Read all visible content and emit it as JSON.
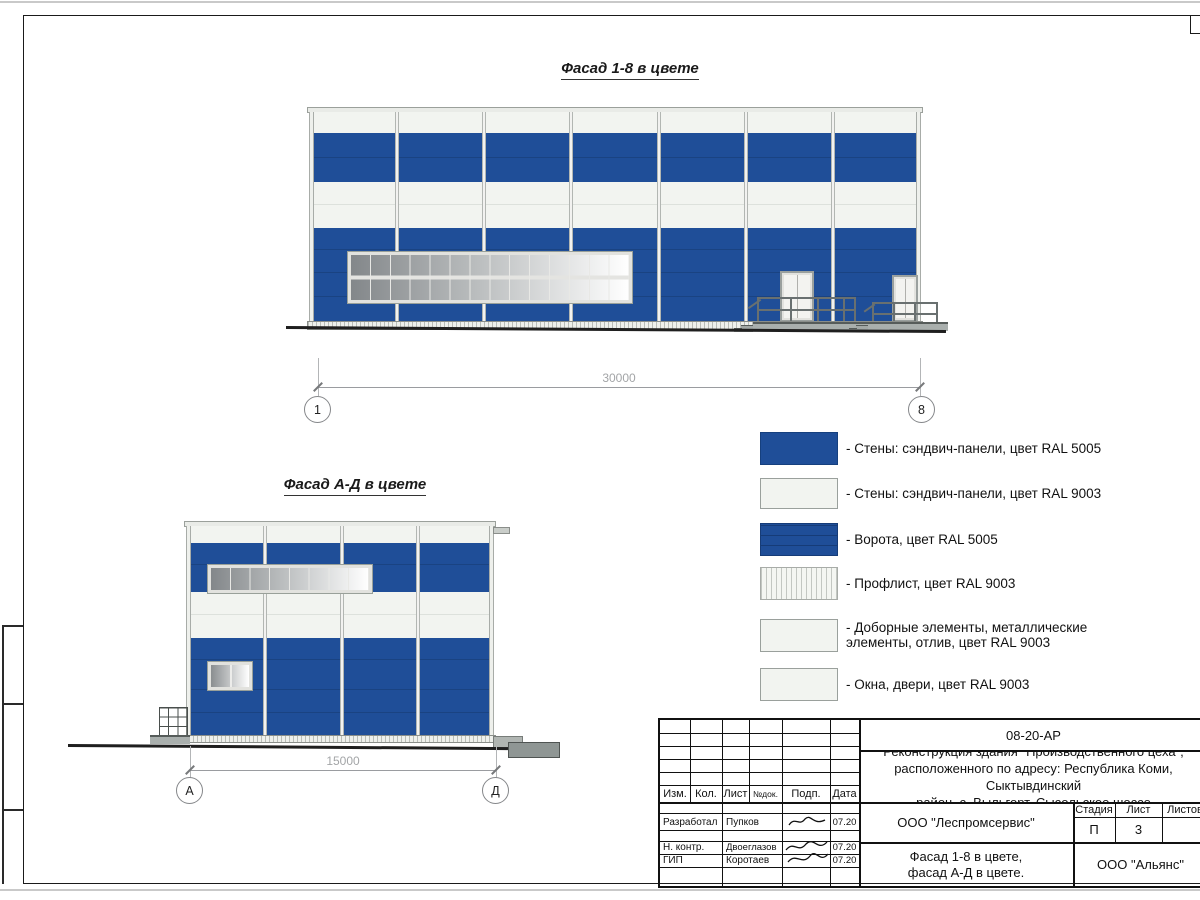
{
  "titles": {
    "facade1": "Фасад 1-8 в цвете",
    "facade2": "Фасад А-Д в цвете"
  },
  "dims": {
    "f1": {
      "value": "30000",
      "left": "1",
      "right": "8"
    },
    "f2": {
      "value": "15000",
      "left": "А",
      "right": "Д"
    }
  },
  "legend": {
    "items": [
      {
        "swatch": "wall-blue",
        "label": "- Стены: сэндвич-панели, цвет RAL 5005"
      },
      {
        "swatch": "wall-white",
        "label": "- Стены: сэндвич-панели, цвет RAL 9003"
      },
      {
        "swatch": "gate-blue",
        "label": "- Ворота, цвет RAL 5005"
      },
      {
        "swatch": "profiled-sheet",
        "label": "- Профлист, цвет RAL 9003"
      },
      {
        "swatch": "trim-elements",
        "label": "- Доборные элементы, металлические элементы, отлив, цвет RAL 9003"
      },
      {
        "swatch": "windows-doors",
        "label": "- Окна, двери, цвет RAL 9003"
      }
    ]
  },
  "tb": {
    "code": "08-20-АР",
    "project": "Реконструкция здания \"Производственного цеха\",\nрасположенного по адресу: Республика Коми, Сыктывдинский\nрайон, с. Выльгорт, Сысольское шоссе",
    "cols": [
      "Изм.",
      "Кол.",
      "Лист",
      "№док.",
      "Подп.",
      "Дата"
    ],
    "rows": [
      {
        "role": "Разработал",
        "name": "Пупков",
        "date": "07.20"
      },
      {
        "role": "Н. контр.",
        "name": "Двоеглазов",
        "date": "07.20"
      },
      {
        "role": "ГИП",
        "name": "Коротаев",
        "date": "07.20"
      }
    ],
    "org1": "ООО \"Леспромсервис\"",
    "org2": "ООО \"Альянс\"",
    "stage_label": "Стадия",
    "sheet_label": "Лист",
    "sheets_label": "Листов",
    "stage_value": "П",
    "sheet_value": "3",
    "doc_title": "Фасад 1-8 в цвете,\nфасад А-Д в цвете."
  },
  "colors": {
    "ral5005_blue": "#1f4e98",
    "ral9003_white": "#f2f4f0",
    "seam_blue": "#1a4382",
    "ground": "#1f1f1f"
  }
}
